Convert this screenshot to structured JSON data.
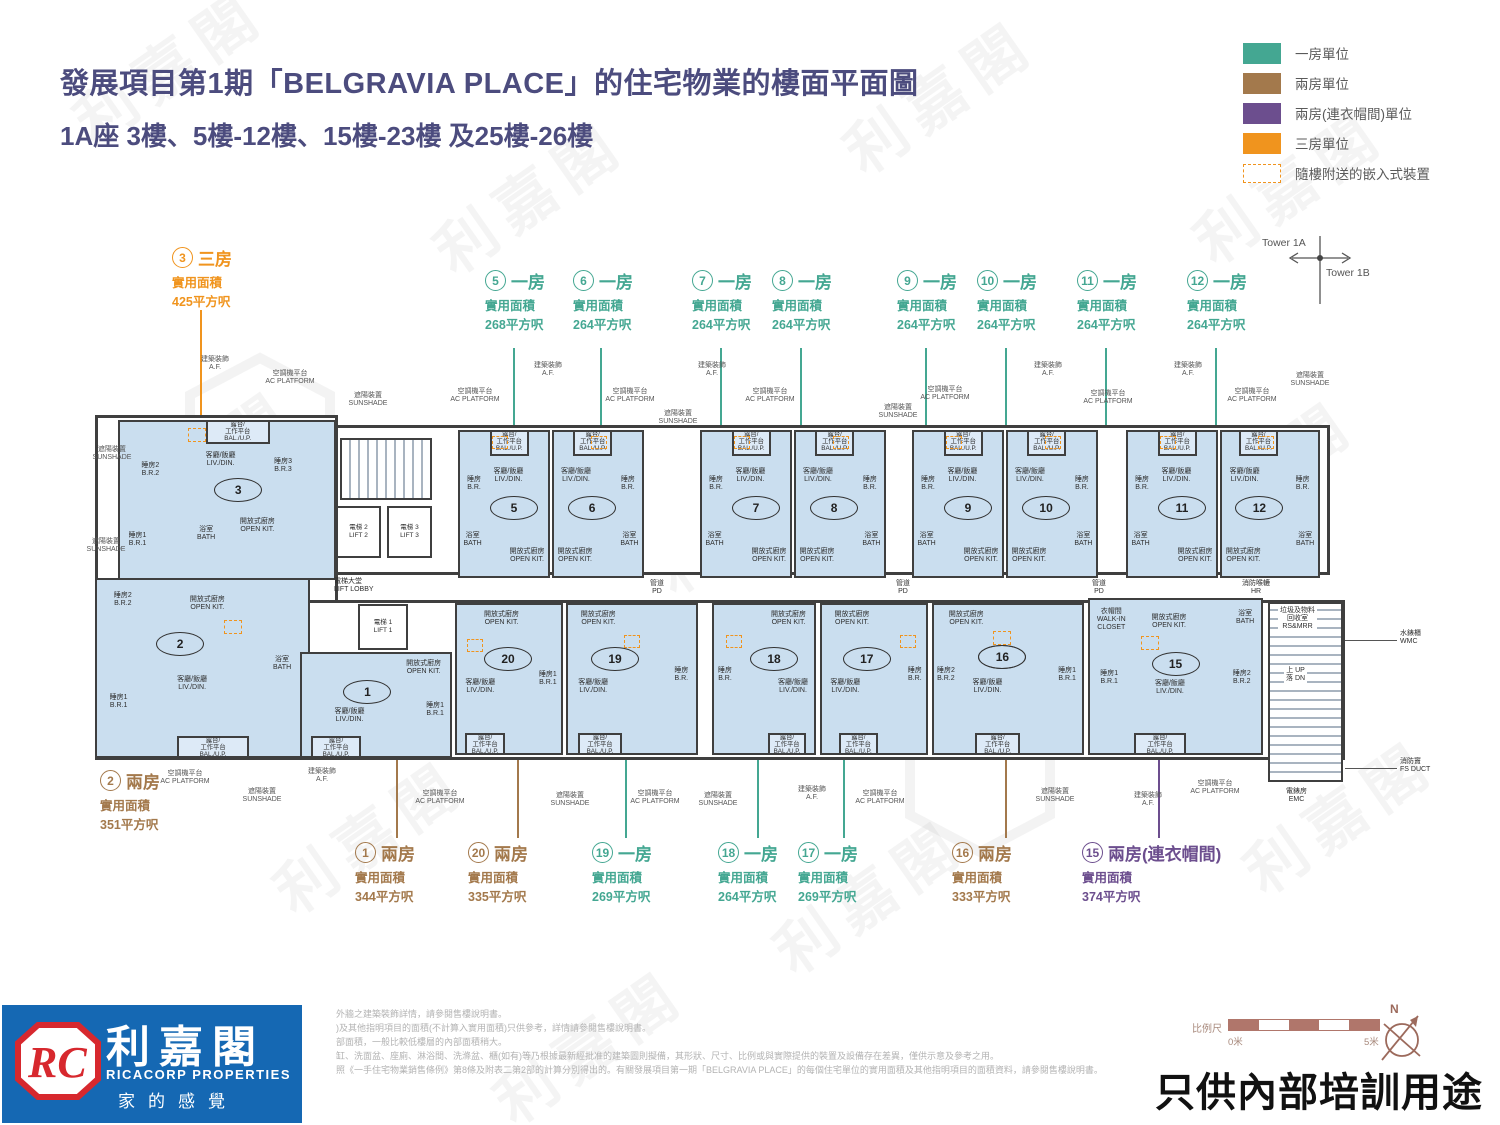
{
  "watermark_text": "利嘉閣",
  "header": {
    "title": "發展項目第1期「BELGRAVIA PLACE」的住宅物業的樓面平面圖",
    "subtitle": "1A座  3樓、5樓-12樓、15樓-23樓 及25樓-26樓"
  },
  "legend": {
    "one_bed": "一房單位",
    "two_bed": "兩房單位",
    "two_bed_closet": "兩房(連衣帽間)單位",
    "three_bed": "三房單位",
    "fittings": "隨樓附送的嵌入式裝置"
  },
  "colors": {
    "one_bed": "#44A792",
    "two_bed": "#A3794C",
    "two_bed_closet": "#6C4E8E",
    "three_bed": "#F0941E",
    "room_fill": "#CADEEF",
    "wall": "#3F3F3F",
    "logo_blue": "#1568B3",
    "logo_red": "#D7282E",
    "scale_brown": "#B0766B",
    "title_text": "#4C4C7E"
  },
  "tower_marker": {
    "left": "Tower 1A",
    "right": "Tower 1B"
  },
  "callouts": {
    "c3": {
      "num": "3",
      "type": "三房",
      "area": "實用面積\n425平方呎"
    },
    "c5": {
      "num": "5",
      "type": "一房",
      "area": "實用面積\n268平方呎"
    },
    "c6": {
      "num": "6",
      "type": "一房",
      "area": "實用面積\n264平方呎"
    },
    "c7": {
      "num": "7",
      "type": "一房",
      "area": "實用面積\n264平方呎"
    },
    "c8": {
      "num": "8",
      "type": "一房",
      "area": "實用面積\n264平方呎"
    },
    "c9": {
      "num": "9",
      "type": "一房",
      "area": "實用面積\n264平方呎"
    },
    "c10": {
      "num": "10",
      "type": "一房",
      "area": "實用面積\n264平方呎"
    },
    "c11": {
      "num": "11",
      "type": "一房",
      "area": "實用面積\n264平方呎"
    },
    "c12": {
      "num": "12",
      "type": "一房",
      "area": "實用面積\n264平方呎"
    },
    "c2": {
      "num": "2",
      "type": "兩房",
      "area": "實用面積\n351平方呎"
    },
    "c1": {
      "num": "1",
      "type": "兩房",
      "area": "實用面積\n344平方呎"
    },
    "c20": {
      "num": "20",
      "type": "兩房",
      "area": "實用面積\n335平方呎"
    },
    "c19": {
      "num": "19",
      "type": "一房",
      "area": "實用面積\n269平方呎"
    },
    "c18": {
      "num": "18",
      "type": "一房",
      "area": "實用面積\n264平方呎"
    },
    "c17": {
      "num": "17",
      "type": "一房",
      "area": "實用面積\n269平方呎"
    },
    "c16": {
      "num": "16",
      "type": "兩房",
      "area": "實用面積\n333平方呎"
    },
    "c15": {
      "num": "15",
      "type": "兩房(連衣帽間)",
      "area": "實用面積\n374平方呎"
    }
  },
  "plan": {
    "unit_numbers": {
      "u1": "1",
      "u2": "2",
      "u3": "3",
      "u5": "5",
      "u6": "6",
      "u7": "7",
      "u8": "8",
      "u9": "9",
      "u10": "10",
      "u11": "11",
      "u12": "12",
      "u15": "15",
      "u16": "16",
      "u17": "17",
      "u18": "18",
      "u19": "19",
      "u20": "20"
    },
    "rooms": {
      "livdin": "客廳/飯廳\nLIV./DIN.",
      "br": "睡房\nB.R.",
      "br1": "睡房1\nB.R.1",
      "br2": "睡房2\nB.R.2",
      "br3": "睡房3\nB.R.3",
      "openkit": "開放式廚房\nOPEN KIT.",
      "bal": "露台/\n工作平台\nBAL./U.P.",
      "bath": "浴室\nBATH",
      "walkin": "衣帽間\nWALK-IN\nCLOSET"
    },
    "core": {
      "lift1": "電梯 1\nLIFT 1",
      "lift2": "電梯 2\nLIFT 2",
      "lift3": "電梯 3\nLIFT 3",
      "lobby": "電梯大堂\nLIFT LOBBY",
      "pd": "管道\nPD",
      "hr": "消防喉轆\nHR",
      "wmc": "水錶櫃\nWMC",
      "emc": "電錶房\nEMC",
      "fsduct": "消防竇\nFS DUCT",
      "rsmrr": "垃圾及物料\n回收室\nRS&MRR",
      "updn": "上 UP\n落 DN"
    },
    "annotations": {
      "ac": "空調機平台\nAC PLATFORM",
      "sun": "遮陽裝置\nSUNSHADE",
      "af": "建築裝飾\nA.F."
    }
  },
  "footer": {
    "logo": {
      "monogram": "RC",
      "name_zh": "利嘉閣",
      "name_en": "RICACORP PROPERTIES",
      "slogan": "家的感覺"
    },
    "disclaimer": {
      "d1": "外牆之建築裝飾詳情，請參閱售樓說明書。",
      "d2": ")及其他指明項目的面積(不計算入實用面積)只供參考，詳情請參閱售樓說明書。",
      "d3": "部面積，一般比較低樓層的內部面積稍大。",
      "d4": "缸、洗面盆、座廁、淋浴間、洗滌盆、櫃(如有)等乃根據最新經批准的建築圖則擬備，其形狀、尺寸、比例或與實際提供的裝置及設備存在差異，僅供示意及參考之用。",
      "d5": "照《一手住宅物業銷售條例》第8條及附表二第2部的計算分別得出的。有關發展項目第一期「BELGRAVIA PLACE」的每個住宅單位的實用面積及其他指明項目的面積資料，請參閱售樓說明書。"
    },
    "scale": {
      "label": "比例尺",
      "left": "0米",
      "right": "5米"
    },
    "compass_n": "N",
    "training_note": "只供內部培訓用途"
  }
}
